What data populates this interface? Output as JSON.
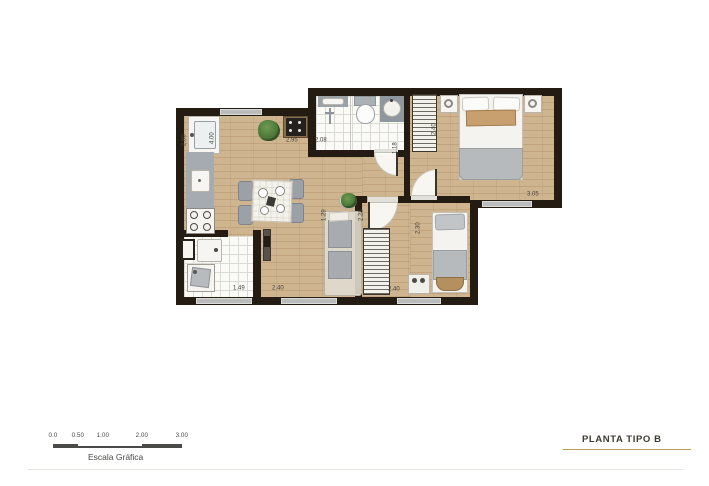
{
  "title_block": {
    "label": "PLANTA TIPO B"
  },
  "scale_bar": {
    "caption": "Escala Gráfica",
    "ticks": [
      "0.0",
      "0.50",
      "1.00",
      "2.00",
      "3.00"
    ]
  },
  "dimensions": [
    {
      "id": "kitchen-counter-run",
      "value": "2.80",
      "orientation": "vertical"
    },
    {
      "id": "kitchen-living-depth",
      "value": "4.00",
      "orientation": "vertical"
    },
    {
      "id": "living-top-width",
      "value": "2.95",
      "orientation": "horizontal"
    },
    {
      "id": "bathroom-width",
      "value": "2.08",
      "orientation": "horizontal"
    },
    {
      "id": "master-wardrobe-width",
      "value": "1.18",
      "orientation": "vertical"
    },
    {
      "id": "master-bedroom-depth",
      "value": "2.40",
      "orientation": "vertical"
    },
    {
      "id": "master-bedroom-width",
      "value": "3.05",
      "orientation": "horizontal"
    },
    {
      "id": "hall-depth-a",
      "value": "1.29",
      "orientation": "vertical"
    },
    {
      "id": "hall-depth-b",
      "value": "2.25",
      "orientation": "vertical"
    },
    {
      "id": "bedroom2-depth",
      "value": "2.30",
      "orientation": "vertical"
    },
    {
      "id": "service-area-width",
      "value": "1.49",
      "orientation": "horizontal"
    },
    {
      "id": "living-bottom-width",
      "value": "2.40",
      "orientation": "horizontal"
    },
    {
      "id": "bedroom2-width",
      "value": "2.40",
      "orientation": "horizontal"
    }
  ],
  "colors": {
    "wall": "#241c12",
    "wood_floor": "#cbb28c",
    "tile_floor": "#fafaf7",
    "counter_gray": "#a5abb1",
    "window_gray": "#b9bcba",
    "accent_gold": "#b5a14d",
    "plant_green": "#4e7d3b",
    "text": "#45423c"
  }
}
